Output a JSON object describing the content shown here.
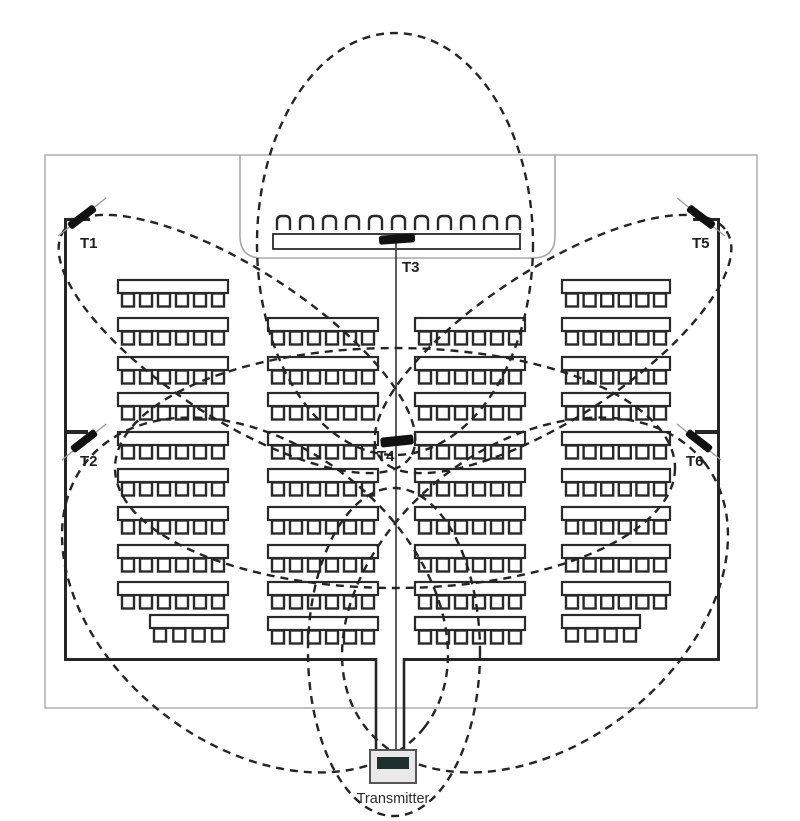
{
  "title": "Auditorium transmitter coverage floor plan",
  "labels": {
    "t1": "T1",
    "t2": "T2",
    "t3": "T3",
    "t4": "T4",
    "t5": "T5",
    "t6": "T6",
    "transmitter": "Transmitter"
  },
  "colors": {
    "wall": "#262626",
    "seat": "#2a2a2a",
    "light_outline": "#a8a8a8",
    "dash": "#242424",
    "antenna": "#111111",
    "antenna_guide": "#9a9a9a",
    "wire": "#4a4a4a",
    "box_fill": "#e9e9e9",
    "box_stroke": "#555555",
    "box_dark": "#20302c",
    "background": "#ffffff"
  },
  "outer_rect": {
    "x": 45,
    "y": 155,
    "w": 712,
    "h": 553
  },
  "room": {
    "left_x": 64,
    "right_x": 717,
    "top_y": 218,
    "bottom_y": 658,
    "wall_thickness": 3,
    "corner_stub_len": 26,
    "aisle": {
      "left_x": 376,
      "right_x": 404,
      "gap_top": 658,
      "gap_bottom": 750
    }
  },
  "stage": {
    "panel": {
      "x": 240,
      "y": 155,
      "w": 315,
      "h": 103,
      "corner_r": 22
    },
    "chairs": {
      "count": 11,
      "start_x": 277,
      "y": 216,
      "w": 13,
      "h": 14,
      "pitch": 23,
      "corner_r": 5
    },
    "table": {
      "x": 273,
      "y": 234,
      "w": 247,
      "h": 15
    }
  },
  "center_line": {
    "x": 396,
    "top_y": 243,
    "bottom_y": 750
  },
  "seating": {
    "desk_height": 13,
    "chair_w": 12,
    "chair_h": 13,
    "chairs_per_full_row": 6,
    "columns": [
      {
        "x": 118,
        "width": 110,
        "row_ys": [
          280,
          318,
          357,
          393,
          432,
          469,
          507,
          545,
          582
        ]
      },
      {
        "x": 268,
        "width": 110,
        "row_ys": [
          318,
          357,
          393,
          432,
          469,
          507,
          545,
          582,
          617
        ]
      },
      {
        "x": 415,
        "width": 110,
        "row_ys": [
          318,
          357,
          393,
          432,
          469,
          507,
          545,
          582,
          617
        ]
      },
      {
        "x": 562,
        "width": 108,
        "row_ys": [
          280,
          318,
          357,
          393,
          432,
          469,
          507,
          545,
          582
        ]
      }
    ],
    "short_rows": [
      {
        "x": 150,
        "y": 615,
        "width": 78,
        "chairs": 4
      },
      {
        "x": 562,
        "y": 615,
        "width": 78,
        "chairs": 4
      }
    ]
  },
  "antennas": [
    {
      "id": "t1",
      "bar": {
        "cx": 82,
        "cy": 217,
        "len": 32,
        "w": 8,
        "rot": -37
      },
      "guide": {
        "x1": 58,
        "y1": 236,
        "x2": 106,
        "y2": 198
      },
      "stub": {
        "x": 64,
        "y": 218,
        "w": 26,
        "h": 3
      },
      "label_x": 80,
      "label_y": 248
    },
    {
      "id": "t2",
      "bar": {
        "cx": 84,
        "cy": 441,
        "len": 30,
        "w": 8,
        "rot": -38
      },
      "guide": {
        "x1": 62,
        "y1": 460,
        "x2": 106,
        "y2": 424
      },
      "stub": {
        "x": 64,
        "y": 430,
        "w": 24,
        "h": 4
      },
      "label_x": 80,
      "label_y": 466
    },
    {
      "id": "t3",
      "bar": {
        "cx": 397,
        "cy": 239,
        "len": 36,
        "w": 9,
        "rot": -4
      },
      "guide": null,
      "stub": null,
      "label_x": 402,
      "label_y": 272
    },
    {
      "id": "t4",
      "bar": {
        "cx": 397,
        "cy": 441,
        "len": 33,
        "w": 10,
        "rot": -6
      },
      "guide": null,
      "stub": null,
      "label_x": 377,
      "label_y": 461
    },
    {
      "id": "t5",
      "bar": {
        "cx": 701,
        "cy": 217,
        "len": 32,
        "w": 8,
        "rot": 37
      },
      "guide": {
        "x1": 677,
        "y1": 198,
        "x2": 725,
        "y2": 236
      },
      "stub": {
        "x": 693,
        "y": 218,
        "w": 26,
        "h": 3
      },
      "label_x": 692,
      "label_y": 248
    },
    {
      "id": "t6",
      "bar": {
        "cx": 699,
        "cy": 441,
        "len": 30,
        "w": 8,
        "rot": 38
      },
      "guide": {
        "x1": 677,
        "y1": 424,
        "x2": 721,
        "y2": 460
      },
      "stub": {
        "x": 695,
        "y": 430,
        "w": 24,
        "h": 4
      },
      "label_x": 686,
      "label_y": 466
    }
  ],
  "coverage_ellipses": [
    {
      "source": "T3",
      "cx": 395,
      "cy": 244,
      "rx": 138,
      "ry": 211,
      "rot": 0
    },
    {
      "source": "T1",
      "cx": 237,
      "cy": 344,
      "rx": 207,
      "ry": 75,
      "rot": 33
    },
    {
      "source": "T5",
      "cx": 553,
      "cy": 344,
      "rx": 207,
      "ry": 75,
      "rot": -33
    },
    {
      "source": "T2",
      "cx": 255,
      "cy": 595,
      "rx": 215,
      "ry": 150,
      "rot": 38
    },
    {
      "source": "T6",
      "cx": 535,
      "cy": 595,
      "rx": 215,
      "ry": 150,
      "rot": -38
    },
    {
      "source": "Transmitter",
      "cx": 394,
      "cy": 652,
      "rx": 86,
      "ry": 164,
      "rot": 0
    },
    {
      "source": "T4",
      "cx": 395,
      "cy": 468,
      "rx": 280,
      "ry": 120,
      "rot": 0
    }
  ],
  "dash_style": {
    "array": "8 6",
    "width": 2.4
  },
  "transmitter_box": {
    "x": 370,
    "y": 750,
    "w": 46,
    "h": 33,
    "inner": {
      "x": 377,
      "y": 757,
      "w": 32,
      "h": 12
    },
    "label_x": 393,
    "label_y": 803
  }
}
